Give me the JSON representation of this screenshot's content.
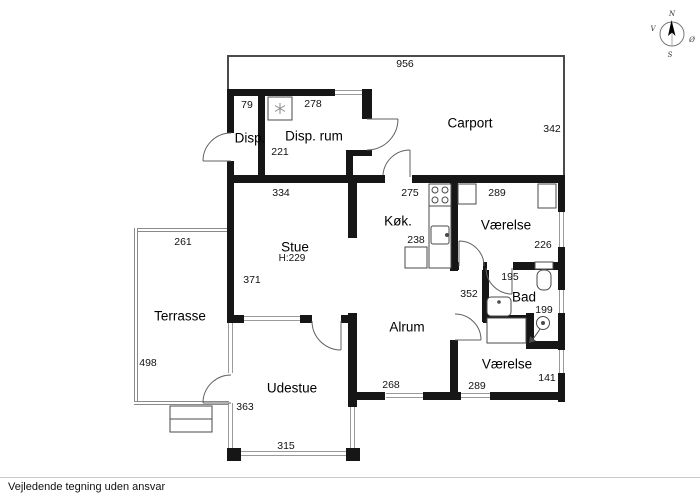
{
  "page": {
    "disclaimer": "Vejledende tegning uden ansvar"
  },
  "compass": {
    "north": "N",
    "east": "Ø",
    "south": "S",
    "west": "V"
  },
  "floorplan": {
    "rooms": [
      {
        "label": "Disp."
      },
      {
        "label": "Disp. rum"
      },
      {
        "label": "Carport"
      },
      {
        "label": "Køk."
      },
      {
        "label": "Værelse"
      },
      {
        "label": "Stue",
        "ceiling_height": "H:229"
      },
      {
        "label": "Terrasse"
      },
      {
        "label": "Bad"
      },
      {
        "label": "Alrum"
      },
      {
        "label": "Værelse"
      },
      {
        "label": "Udestue"
      }
    ],
    "dimensions": [
      "956",
      "79",
      "278",
      "342",
      "221",
      "334",
      "275",
      "289",
      "238",
      "226",
      "261",
      "371",
      "195",
      "352",
      "199",
      "498",
      "268",
      "289",
      "141",
      "363",
      "315"
    ]
  }
}
